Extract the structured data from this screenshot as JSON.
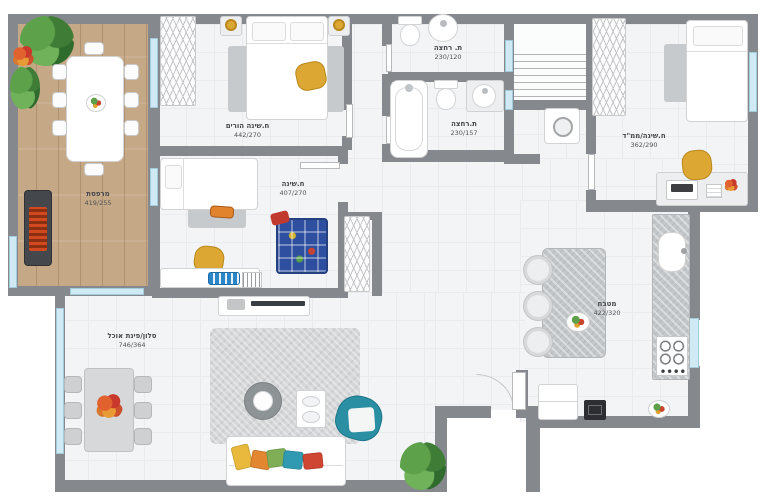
{
  "rooms": [
    {
      "name": "מרפסת",
      "dims": "419/255"
    },
    {
      "name": "ח.שינה הורים",
      "dims": "442/270"
    },
    {
      "name": "ת. רחצה",
      "dims": "230/120"
    },
    {
      "name": "ת.רחצה",
      "dims": "230/157"
    },
    {
      "name": "ח.שינה/ממ\"ד",
      "dims": "362/290"
    },
    {
      "name": "ח.שינה",
      "dims": "407/270"
    },
    {
      "name": "מטבח",
      "dims": "422/320"
    },
    {
      "name": "סלון/פינת אוכל",
      "dims": "746/364"
    }
  ],
  "colors": {
    "wall": "#85888c",
    "floor": "#f3f4f6",
    "wood_deck": "#c5a886",
    "window_glass": "#cfeaf5",
    "accent_teal": "#2b8fa3",
    "accent_mustard": "#dca733",
    "play_rug_blue": "#2e4f9f"
  }
}
